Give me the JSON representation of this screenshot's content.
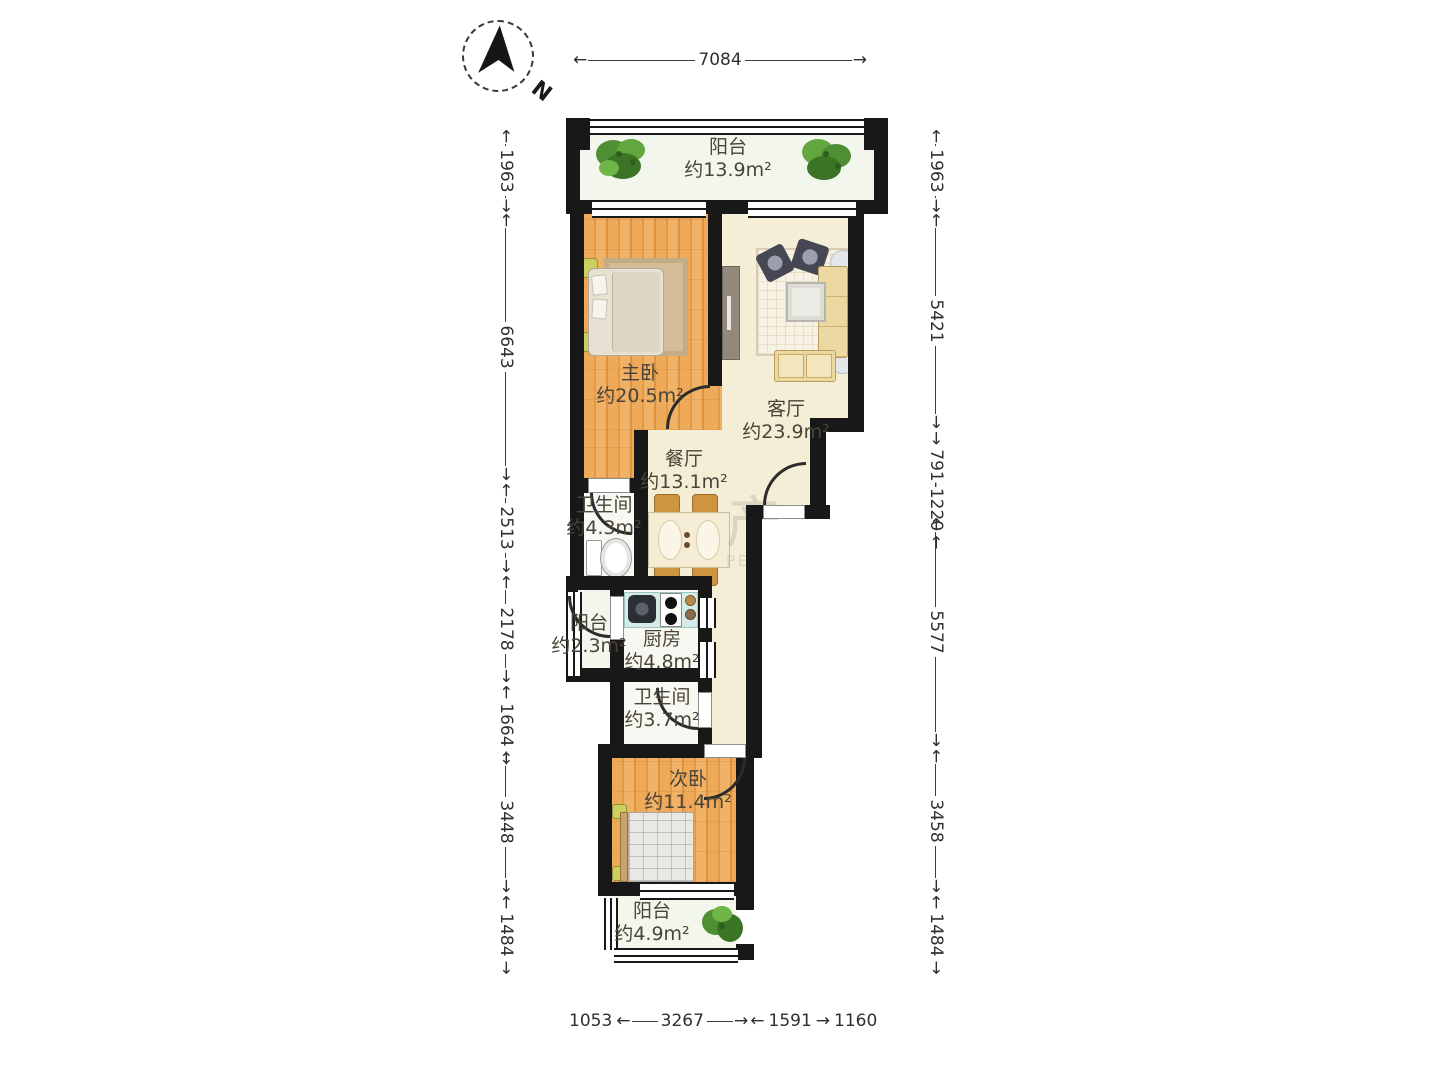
{
  "compass": {
    "label": "N"
  },
  "dimensions": {
    "top": "7084",
    "left": [
      "1963",
      "6643",
      "2513",
      "2178",
      "1664",
      "3448",
      "1484"
    ],
    "right": [
      "1963",
      "5421",
      "791-1220",
      "5577",
      "3458",
      "1484"
    ],
    "bottom": [
      "1053",
      "3267",
      "1591",
      "1160"
    ]
  },
  "rooms": {
    "balcony_top": {
      "name": "阳台",
      "area": "约13.9m²"
    },
    "master_bedroom": {
      "name": "主卧",
      "area": "约20.5m²"
    },
    "living_room": {
      "name": "客厅",
      "area": "约23.9m²"
    },
    "dining_room": {
      "name": "餐厅",
      "area": "约13.1m²"
    },
    "bathroom_main": {
      "name": "卫生间",
      "area": "约4.3m²"
    },
    "balcony_side": {
      "name": "阳台",
      "area": "约2.3m²"
    },
    "kitchen": {
      "name": "厨房",
      "area": "约4.8m²"
    },
    "bathroom_second": {
      "name": "卫生间",
      "area": "约3.7m²"
    },
    "second_bedroom": {
      "name": "次卧",
      "area": "约11.4m²"
    },
    "balcony_bottom": {
      "name": "阳台",
      "area": "约4.9m²"
    }
  },
  "watermark": {
    "glyph": "产",
    "text": "PER"
  },
  "colors": {
    "wall": "#181818",
    "wood_floor": "#eca757",
    "cream_floor": "#f5eed6",
    "bath_floor": "#f7f8f2",
    "balcony_floor": "#f3f6ec",
    "kitchen_counter": "#d4ebe7",
    "plant_green": "#4e8f33",
    "dimension_text": "#2f2f2f"
  }
}
